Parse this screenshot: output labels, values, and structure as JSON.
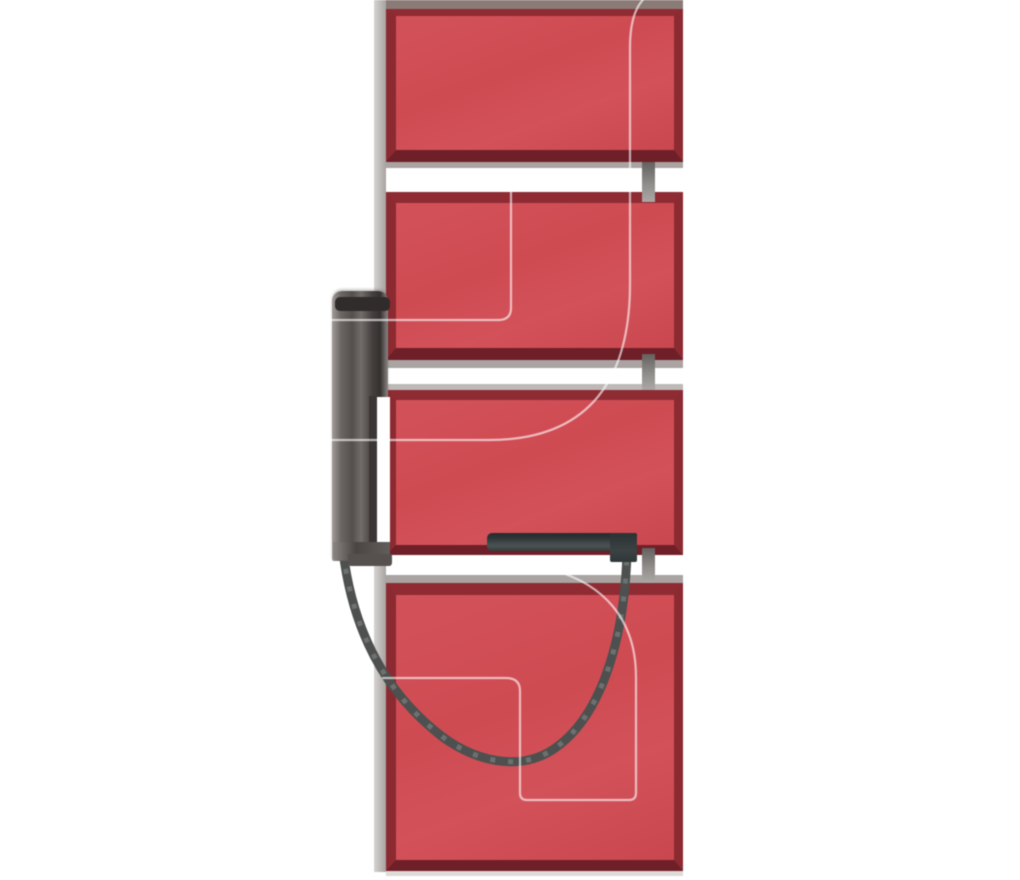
{
  "image": {
    "alt_text": "Side view of a red multi-panel electric radiator: four flat red panels stacked with white gaps, mounted on a light gray wall rail, with a dark gray electric heating element handle on the left and a black power cable looping down to the element bar, over a faint white logo watermark",
    "background": "#ffffff"
  },
  "colors": {
    "background": "#ffffff",
    "panel_red": "#cf4b52",
    "panel_red_light": "#d3525a",
    "panel_red_dark": "#c94850",
    "border_red": "#8e2b33",
    "border_red_side": "#8c2a31",
    "border_red_bottom": "#6e1f27",
    "top_strip_brown": "#8b7b76",
    "rail_gray_light": "#d6d3d1",
    "rail_gray_dark": "#a8a3a0",
    "strip_gray": "#a9a4a1",
    "strip_gray_light": "#bdb9b6",
    "shadow_gray": "#dedbd9",
    "connector_top": "#64615f",
    "connector_bottom": "#aba8a5",
    "handle_cap": "#302c2b",
    "handle_rod": "#3b3634",
    "bar_dark": "#252c2d",
    "bar_mid": "#434b4c",
    "cable": "#4d504f",
    "watermark": "rgba(255,255,255,0.62)"
  },
  "scene": {
    "rail": {
      "x": 374,
      "y": 0,
      "w": 12,
      "h": 872
    },
    "panels": [
      {
        "x": 386,
        "y": 9,
        "w": 297,
        "h": 153,
        "bt": 7,
        "bb": 12,
        "bl": 10,
        "br": 9
      },
      {
        "x": 386,
        "y": 192,
        "w": 297,
        "h": 168,
        "bt": 11,
        "bb": 12,
        "bl": 10,
        "br": 9
      },
      {
        "x": 386,
        "y": 390,
        "w": 297,
        "h": 165,
        "bt": 10,
        "bb": 10,
        "bl": 10,
        "br": 9
      },
      {
        "x": 386,
        "y": 583,
        "w": 297,
        "h": 288,
        "bt": 12,
        "bb": 11,
        "bl": 10,
        "br": 9
      }
    ],
    "strips": [
      {
        "x": 386,
        "y": 0,
        "w": 297,
        "h": 9,
        "color": "top_strip_brown"
      },
      {
        "x": 386,
        "y": 162,
        "w": 297,
        "h": 6,
        "color": "strip_gray"
      },
      {
        "x": 386,
        "y": 360,
        "w": 297,
        "h": 8,
        "color": "strip_gray"
      },
      {
        "x": 386,
        "y": 384,
        "w": 297,
        "h": 6,
        "color": "strip_gray_light"
      },
      {
        "x": 386,
        "y": 575,
        "w": 297,
        "h": 8,
        "color": "strip_gray"
      },
      {
        "x": 386,
        "y": 871,
        "w": 297,
        "h": 5,
        "color": "shadow_gray"
      }
    ],
    "connectors": [
      {
        "x": 642,
        "y": 162,
        "w": 13,
        "h": 40
      },
      {
        "x": 642,
        "y": 354,
        "w": 13,
        "h": 36
      },
      {
        "x": 642,
        "y": 548,
        "w": 13,
        "h": 35
      }
    ],
    "handle": {
      "body": {
        "x": 332,
        "y": 291,
        "w": 56,
        "h": 270
      },
      "cap": {
        "x": 335,
        "y": 297,
        "w": 55,
        "h": 14
      },
      "rod": {
        "x": 369,
        "y": 396,
        "w": 7,
        "h": 152
      },
      "channel": {
        "x": 377,
        "y": 397,
        "w": 13,
        "h": 148
      },
      "foot": {
        "x": 333,
        "y": 542,
        "w": 57,
        "h": 18
      },
      "foot_step": {
        "x": 348,
        "y": 554,
        "w": 44,
        "h": 12
      }
    },
    "element_bar": {
      "bar": {
        "x": 487,
        "y": 533,
        "w": 150,
        "h": 18
      },
      "end_block": {
        "x": 610,
        "y": 533,
        "w": 27,
        "h": 29
      }
    },
    "cable_path": "M 343,551 C 352,625 381,686 434,730 C 471,762 522,774 558,746 C 598,716 624,648 627,553",
    "watermark_paths": [
      "M 652,-8 C 636,2 630,20 630,48 L 630,284 C 630,376 592,440 489,440 L 328,440",
      "M 511,186 L 511,308 Q 511,320 498,320 L 328,320",
      "M 556,571 C 600,584 636,616 636,677 L 636,793 Q 636,800 629,800 L 527,800 Q 520,800 520,793 L 520,691 Q 520,678 506,678 L 383,678"
    ]
  }
}
